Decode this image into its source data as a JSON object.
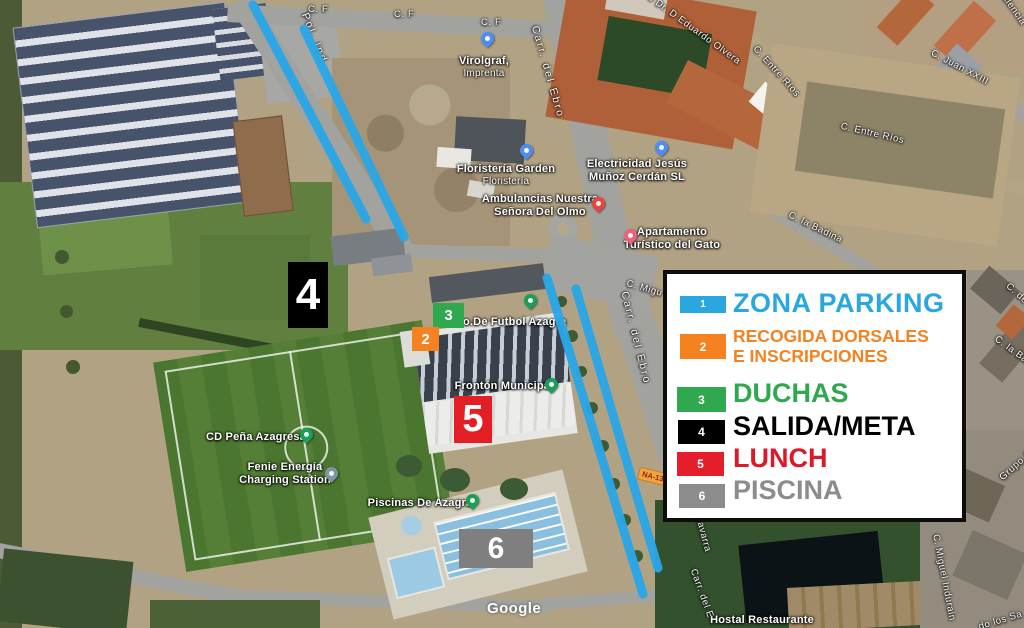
{
  "legend": {
    "items": [
      {
        "num": "1",
        "label": "ZONA PARKING",
        "color": "#2AA7DF"
      },
      {
        "num": "2",
        "label": "RECOGIDA DORSALES",
        "label_line2": "E INSCRIPCIONES",
        "color": "#F58220"
      },
      {
        "num": "3",
        "label": "DUCHAS",
        "color": "#2FA84F"
      },
      {
        "num": "4",
        "label": "SALIDA/META",
        "color": "#000000"
      },
      {
        "num": "5",
        "label": "LUNCH",
        "color": "#D91A2A"
      },
      {
        "num": "6",
        "label": "PISCINA",
        "color": "#8C8C8C"
      }
    ]
  },
  "map_markers": {
    "parking_line_color": "#29A7E8",
    "box2": "2",
    "box3": "3",
    "box4": "4",
    "box5": "5",
    "box6": "6"
  },
  "pois": {
    "virolgraf": {
      "l1": "Virolgraf,",
      "l2": "Imprenta"
    },
    "floristeria": {
      "l1": "Floristería Garden",
      "l2": "Floristería"
    },
    "electricidad": {
      "l1": "Electricidad Jesús",
      "l2": "Muñoz Cerdán SL"
    },
    "ambulancias": {
      "l1": "Ambulancias Nuestra",
      "l2": "Señora Del Olmo"
    },
    "apartamento": {
      "l1": "Apartamento",
      "l2": "Turístico del Gato"
    },
    "campo": {
      "l1": "o.De Futbol Azagra"
    },
    "fronton": {
      "l1": "Frontón Municipal"
    },
    "pena": {
      "l1": "CD Peña Azagresa"
    },
    "fenie": {
      "l1": "Fenie Energía",
      "l2": "Charging Station"
    },
    "piscinas": {
      "l1": "Piscinas De Azagra"
    },
    "hostal": {
      "l1": "Hostal Restaurante"
    }
  },
  "streets": {
    "cf1": "C. F",
    "cf2": "C. F",
    "cf3": "C. F",
    "pol_ind": "Pol. Ind",
    "carr_ebro_top": "Carr. del Ebro",
    "eduardo": "Po Dr. D Eduardo Olvera",
    "entre_rios_a": "C. Entre Ríos",
    "entre_rios_b": "C. Entre Ríos",
    "juan_xxiii": "C. Juan XXIII",
    "valencia": "Valencia",
    "badina": "C. la Badina",
    "badina2": "C. la Ba",
    "c_de": "C. de",
    "miguel_top": "C. Migu",
    "carr_ebro_mid": "Carr. del Ebro",
    "navarra": "Navarra",
    "carr_ebro_bot": "Carr. del E",
    "miguel_indurain": "C. Miguel Indurain",
    "grupo": "Grupo S",
    "los_santos": "do los Sa"
  },
  "route_badge": "NA-13",
  "watermark": "Google"
}
